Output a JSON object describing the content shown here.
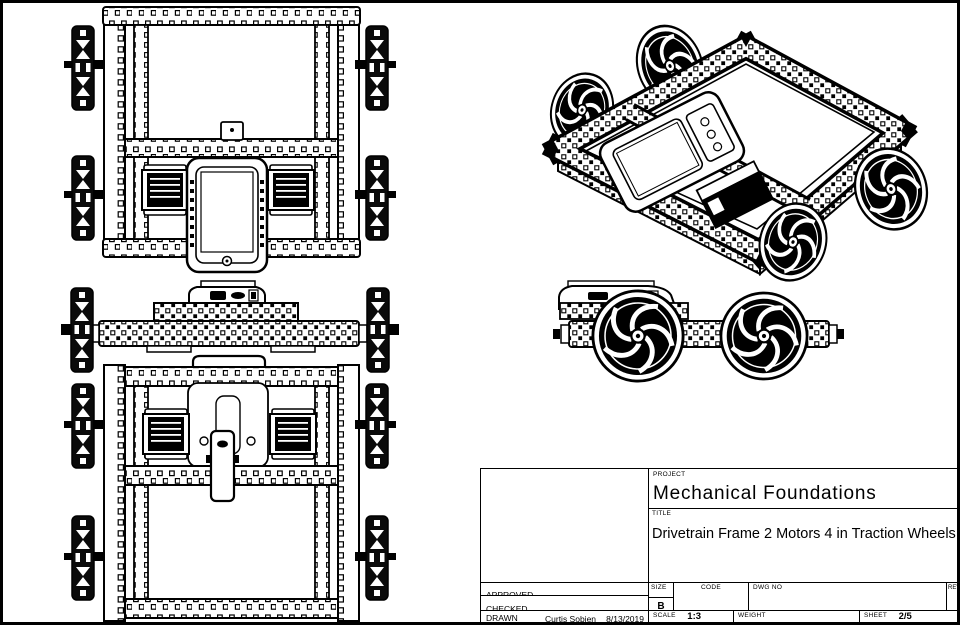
{
  "sheet": {
    "background": "#ffffff",
    "line_color": "#000000",
    "views": [
      "top-view",
      "front-elevation-view",
      "bottom-view",
      "isometric-view",
      "side-elevation-view"
    ]
  },
  "title_block": {
    "project_label": "PROJECT",
    "project_name": "Mechanical Foundations",
    "title_label": "TITLE",
    "drawing_title": "Drivetrain Frame 2 Motors 4 in Traction Wheels",
    "approved_label": "APPROVED",
    "approved_value": "",
    "checked_label": "CHECKED",
    "checked_value": "",
    "drawn_label": "DRAWN",
    "drawn_by": "Curtis Sobien",
    "drawn_date": "8/13/2019",
    "size_label": "SIZE",
    "size_value": "B",
    "code_label": "CODE",
    "code_value": "",
    "dwg_no_label": "DWG NO",
    "dwg_no_value": "",
    "rev_label": "REV",
    "rev_value": "",
    "scale_label": "SCALE",
    "scale_value": "1:3",
    "weight_label": "WEIGHT",
    "weight_value": "",
    "sheet_label": "SHEET",
    "sheet_value": "2/5"
  }
}
